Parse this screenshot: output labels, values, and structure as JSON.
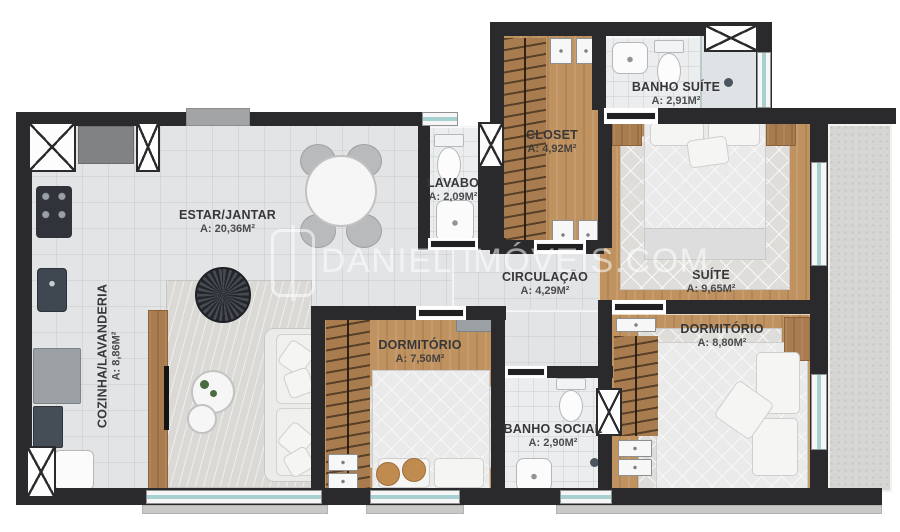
{
  "plan": {
    "watermark": {
      "text": "DANIEL IMÓVEIS.COM"
    },
    "rooms": [
      {
        "id": "estar-jantar",
        "name": "ESTAR/JANTAR",
        "area": "A: 20,36M²"
      },
      {
        "id": "cozinha",
        "name": "COZINHA/LAVANDERIA",
        "area": "A: 8,86M²"
      },
      {
        "id": "lavabo",
        "name": "LAVABO",
        "area": "A: 2,09M²"
      },
      {
        "id": "closet",
        "name": "CLOSET",
        "area": "A: 4,92M²"
      },
      {
        "id": "banho-suite",
        "name": "BANHO SUÍTE",
        "area": "A: 2,91M²"
      },
      {
        "id": "suite",
        "name": "SUÍTE",
        "area": "A: 9,65M²"
      },
      {
        "id": "circulacao",
        "name": "CIRCULAÇÃO",
        "area": "A: 4,29M²"
      },
      {
        "id": "dormitorio-1",
        "name": "DORMITÓRIO",
        "area": "A: 7,50M²"
      },
      {
        "id": "banho-social",
        "name": "BANHO SOCIAL",
        "area": "A: 2,90M²"
      },
      {
        "id": "dormitorio-2",
        "name": "DORMITÓRIO",
        "area": "A: 8,80M²"
      }
    ],
    "colors": {
      "wall": "#2a2a2c",
      "wood_floor": "#bf9260",
      "tile_floor": "#e3e4e6",
      "glass": "#a6d1d0",
      "label_text": "#37373a",
      "watermark": "rgba(255,255,255,0.55)"
    }
  }
}
